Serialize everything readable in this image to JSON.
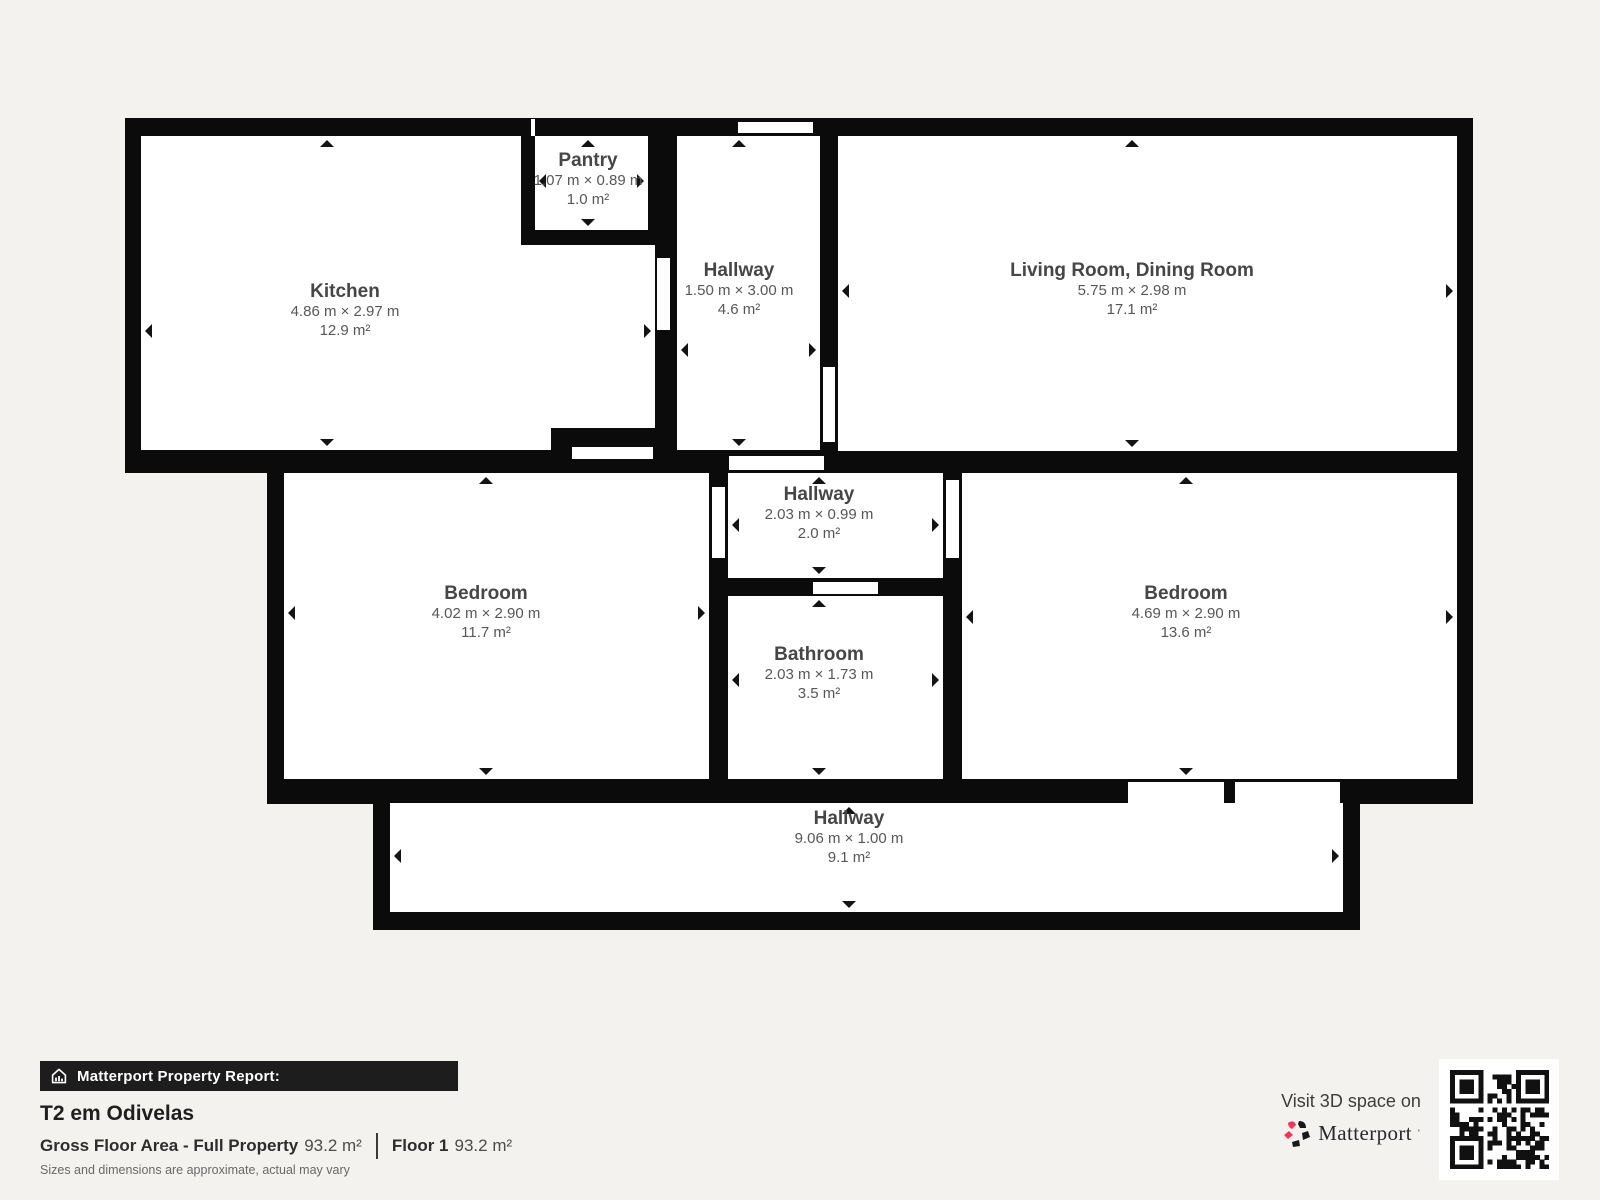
{
  "colors": {
    "background": "#f3f2ef",
    "wall": "#0b0b0b",
    "floor": "#ffffff",
    "label": "#464646",
    "dims": "#575757",
    "accent": "#ff3158"
  },
  "floorplan": {
    "rooms": [
      {
        "id": "kitchen",
        "name": "Kitchen",
        "dimensions": "4.86 m × 2.97 m",
        "area": "12.9 m²"
      },
      {
        "id": "pantry",
        "name": "Pantry",
        "dimensions": "1.07 m × 0.89 m",
        "area": "1.0 m²"
      },
      {
        "id": "hallway-top",
        "name": "Hallway",
        "dimensions": "1.50 m × 3.00 m",
        "area": "4.6 m²"
      },
      {
        "id": "living-dining",
        "name": "Living Room, Dining Room",
        "dimensions": "5.75 m × 2.98 m",
        "area": "17.1 m²"
      },
      {
        "id": "bedroom-left",
        "name": "Bedroom",
        "dimensions": "4.02 m × 2.90 m",
        "area": "11.7 m²"
      },
      {
        "id": "hallway-middle",
        "name": "Hallway",
        "dimensions": "2.03 m × 0.99 m",
        "area": "2.0 m²"
      },
      {
        "id": "bathroom",
        "name": "Bathroom",
        "dimensions": "2.03 m × 1.73 m",
        "area": "3.5 m²"
      },
      {
        "id": "bedroom-right",
        "name": "Bedroom",
        "dimensions": "4.69 m × 2.90 m",
        "area": "13.6 m²"
      },
      {
        "id": "hallway-bottom",
        "name": "Hallway",
        "dimensions": "9.06 m × 1.00 m",
        "area": "9.1 m²"
      }
    ]
  },
  "report": {
    "header": "Matterport Property Report:",
    "property_title": "T2 em Odivelas",
    "gross_label": "Gross Floor Area - Full Property",
    "gross_value": "93.2 m²",
    "floor_label": "Floor 1",
    "floor_value": "93.2 m²",
    "disclaimer": "Sizes and dimensions are approximate, actual may vary"
  },
  "brand": {
    "visit_text": "Visit 3D space on",
    "wordmark": "Matterport",
    "mark": "'"
  }
}
